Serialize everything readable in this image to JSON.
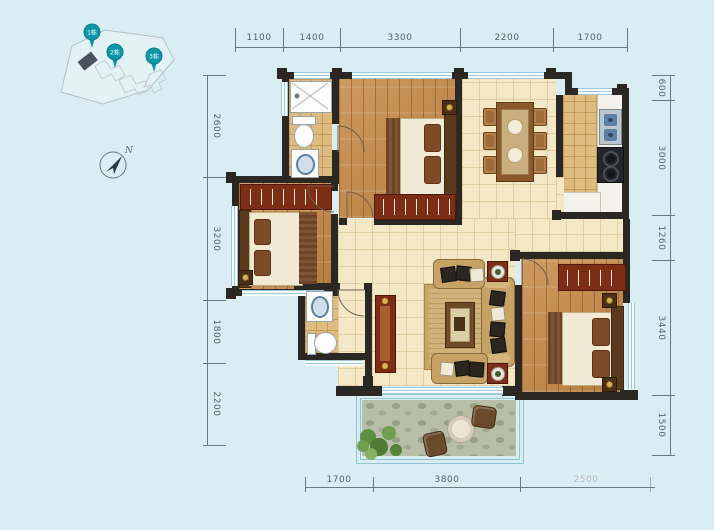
{
  "site_map": {
    "pins": [
      {
        "label": "1栋"
      },
      {
        "label": "2栋"
      },
      {
        "label": "3栋"
      }
    ],
    "pin_color": "#0d96a8"
  },
  "compass": {
    "north": "N"
  },
  "dimensions": {
    "top": [
      "1100",
      "1400",
      "3300",
      "2200",
      "1700"
    ],
    "left": [
      "2600",
      "3200",
      "1800",
      "2200"
    ],
    "right": [
      "600",
      "3000",
      "1260",
      "3440",
      "1500"
    ],
    "bottom": [
      "1700",
      "3800",
      "2500"
    ]
  },
  "colors": {
    "background": "#d9edf2",
    "wall": "#2b2722",
    "wood_floor": "#c18a4f",
    "tile_tan": "#debc80",
    "tile_cream": "#f4e7c5",
    "balcony_floor": "#b8bfa9",
    "wardrobe": "#7c2d14",
    "dimension_text": "#54646d"
  }
}
